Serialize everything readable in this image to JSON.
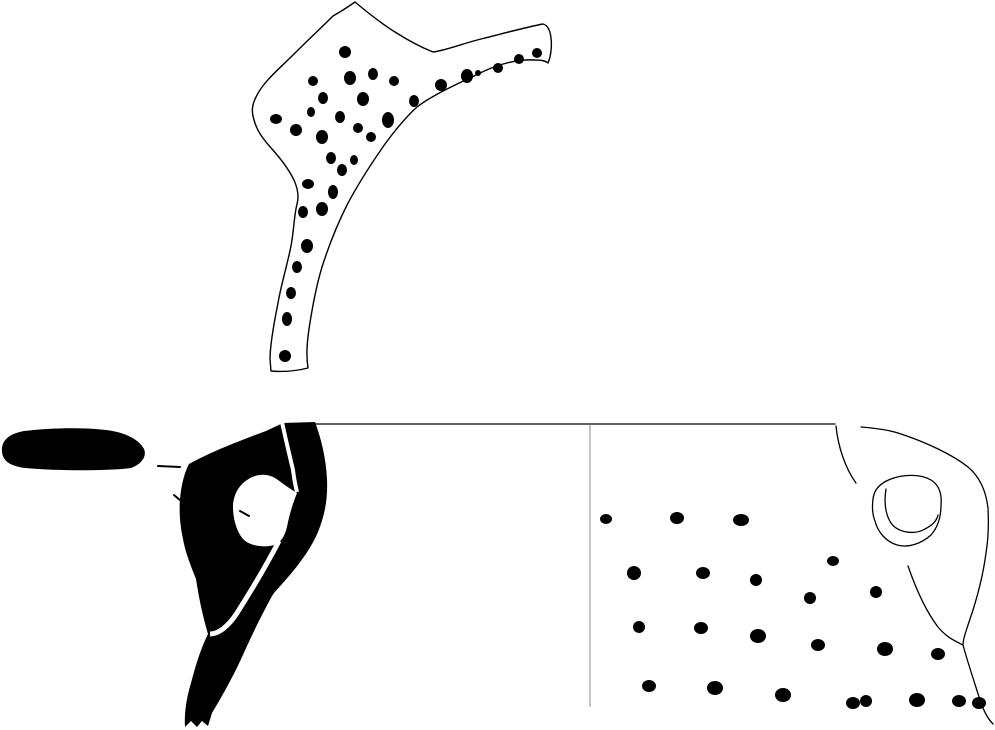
{
  "canvas": {
    "width": 995,
    "height": 730,
    "background": "#ffffff"
  },
  "palette": {
    "ink": "#000000",
    "paper": "#ffffff",
    "divider_line": "#888888"
  },
  "figures": [
    {
      "name": "decorated-sherd-top",
      "shapes": [
        {
          "name": "sherd-outline",
          "type": "path",
          "fill": "#ffffff",
          "stroke": "#000000",
          "sw": 1.4,
          "d": "M355 2 C348 7 340 12 333 16 C322 27 308 40 293 55 C279 69 263 82 256 97 C251 107 252 113 254 120 C257 131 263 139 272 149 C281 159 289 170 294 180 C298 189 299 197 297 204 C294 216 294 230 291 246 C287 266 281 285 278 303 C274 323 270 346 270 359 L271 371 C282 372 296 371 308 368 C306 355 307 343 309 329 C312 309 316 287 322 267 C329 245 337 225 347 205 C358 184 371 164 385 144 C396 129 407 116 417 107 C431 96 455 85 478 74 C498 64 518 59 535 60 C541 60 546 61 548 63 C551 56 552 46 551 38 C550 29 547 25 543 24 C527 27 505 33 481 39 C461 44 444 51 433 52 C423 48 409 41 395 32 C382 24 367 12 355 2 Z"
        },
        {
          "name": "punctate-dot",
          "type": "dots",
          "fill": "#000000",
          "items": [
            [
              345,
              52,
              6,
              6
            ],
            [
              313,
              81,
              5,
              5
            ],
            [
              350,
              78,
              6,
              7
            ],
            [
              373,
              74,
              5,
              6
            ],
            [
              394,
              81,
              5,
              5
            ],
            [
              441,
              85,
              6,
              6
            ],
            [
              467,
              76,
              6,
              7
            ],
            [
              478,
              73,
              3,
              3
            ],
            [
              498,
              68,
              5,
              5
            ],
            [
              519,
              59,
              5,
              5
            ],
            [
              537,
              53,
              5,
              5
            ],
            [
              323,
              98,
              5,
              6
            ],
            [
              363,
              99,
              6,
              7
            ],
            [
              414,
              101,
              5,
              6
            ],
            [
              311,
              112,
              4,
              5
            ],
            [
              276,
              119,
              6,
              5
            ],
            [
              340,
              117,
              5,
              6
            ],
            [
              388,
              120,
              6,
              8
            ],
            [
              296,
              130,
              6,
              6
            ],
            [
              358,
              128,
              5,
              5
            ],
            [
              322,
              137,
              6,
              7
            ],
            [
              371,
              137,
              5,
              5
            ],
            [
              331,
              158,
              5,
              6
            ],
            [
              354,
              160,
              4,
              5
            ],
            [
              342,
              170,
              5,
              6
            ],
            [
              308,
              184,
              6,
              5
            ],
            [
              333,
              192,
              5,
              7
            ],
            [
              303,
              212,
              5,
              6
            ],
            [
              322,
              209,
              6,
              7
            ],
            [
              307,
              246,
              6,
              7
            ],
            [
              297,
              267,
              5,
              6
            ],
            [
              291,
              293,
              5,
              6
            ],
            [
              287,
              319,
              5,
              7
            ],
            [
              285,
              356,
              6,
              6
            ]
          ]
        }
      ]
    },
    {
      "name": "handle-profile-left",
      "shapes": [
        {
          "name": "rim-section-blob",
          "type": "path",
          "fill": "#000000",
          "d": "M2 452 C1 441 8 434 24 431 C48 428 82 427 106 430 C124 432 139 439 144 449 C147 456 142 464 131 468 C108 471 58 471 25 468 C10 466 3 461 2 452 Z"
        },
        {
          "name": "profile-silhouette",
          "type": "path",
          "fill": "#000000",
          "d": "M283 423 L315 422 C321 438 326 458 327 479 C328 501 324 517 318 532 C309 553 294 571 274 593 L272 596 C261 616 251 637 242 657 C233 677 221 698 212 713 L208 726 L202 721 L197 727 L191 721 L185 727 C184 712 187 696 191 683 C196 664 201 648 208 634 C203 617 199 599 196 579 C190 564 185 551 183 539 C180 526 179 512 180 499 C181 487 184 473 189 464 C212 451 247 438 266 431 Z"
        },
        {
          "name": "handle-opening",
          "type": "path",
          "fill": "#ffffff",
          "d": "M233 507 C233 496 238 486 247 480 C257 473 269 473 278 480 C286 486 292 490 297 493 C293 503 290 513 288 522 C286 533 283 540 277 544 C268 548 252 547 244 540 C237 533 233 519 233 507 Z"
        },
        {
          "name": "rim-separation-line",
          "type": "path",
          "stroke": "#ffffff",
          "sw": 4,
          "cap": "butt",
          "d": "M282 422 C286 441 290 457 293 470 C294 478 296 488 297 492"
        },
        {
          "name": "handle-edge-line",
          "type": "path",
          "stroke": "#ffffff",
          "sw": 5,
          "cap": "butt",
          "d": "M279 541 C267 564 251 591 237 613 C228 627 218 634 210 634"
        },
        {
          "name": "tick-mark",
          "type": "path",
          "stroke": "#000000",
          "sw": 2,
          "d": "M158 466 L180 467"
        },
        {
          "name": "tick-mark",
          "type": "path",
          "stroke": "#000000",
          "sw": 2,
          "d": "M174 495 L181 501"
        },
        {
          "name": "tick-mark",
          "type": "path",
          "stroke": "#000000",
          "sw": 2,
          "d": "M240 511 L249 516"
        }
      ]
    },
    {
      "name": "vessel-view-right",
      "shapes": [
        {
          "name": "rim-top-line",
          "type": "path",
          "stroke": "#000000",
          "sw": 1.3,
          "d": "M313 424 L835 424"
        },
        {
          "name": "center-divider-line",
          "type": "path",
          "stroke": "#888888",
          "sw": 1,
          "cap": "butt",
          "d": "M590 425 L590 707"
        },
        {
          "name": "handle-attachment-curve",
          "type": "path",
          "stroke": "#000000",
          "sw": 1.3,
          "d": "M836 426 C838 446 845 468 856 483"
        },
        {
          "name": "rim-and-right-contour",
          "type": "path",
          "stroke": "#000000",
          "sw": 1.3,
          "d": "M861 427 C873 428 889 430 898 433 C926 442 953 455 968 467 C980 477 986 491 988 508 C989 527 988 541 986 553 C983 576 977 599 969 622 C965 634 963 640 963 645 C967 660 974 681 980 700 C984 712 988 719 993 724"
        },
        {
          "name": "body-contour-curve",
          "type": "path",
          "stroke": "#000000",
          "sw": 1.3,
          "d": "M908 566 C916 589 925 610 938 627 C946 637 955 641 963 645"
        },
        {
          "name": "handle-scar-outer",
          "type": "path",
          "stroke": "#000000",
          "sw": 1.3,
          "d": "M873 499 C874 490 880 483 891 479 C904 474 921 474 931 480 C939 485 942 494 941 505 C941 517 938 527 931 535 C921 544 908 548 897 545 C887 542 878 533 875 521 C872 514 872 507 873 499 Z"
        },
        {
          "name": "handle-scar-inner",
          "type": "path",
          "stroke": "#000000",
          "sw": 1.3,
          "d": "M886 489 C884 501 885 514 891 523 C898 533 915 535 925 529 C933 525 937 520 938 515"
        },
        {
          "name": "punctate-dot",
          "type": "dots",
          "fill": "#000000",
          "items": [
            [
              606,
              519,
              6,
              5
            ],
            [
              677,
              518,
              7,
              6
            ],
            [
              741,
              520,
              8,
              6
            ],
            [
              634,
              573,
              7,
              7
            ],
            [
              703,
              573,
              7,
              6
            ],
            [
              756,
              580,
              6,
              6
            ],
            [
              833,
              561,
              6,
              5
            ],
            [
              876,
              592,
              6,
              6
            ],
            [
              810,
              598,
              6,
              6
            ],
            [
              639,
              627,
              6,
              6
            ],
            [
              701,
              628,
              7,
              6
            ],
            [
              758,
              636,
              8,
              7
            ],
            [
              818,
              645,
              7,
              6
            ],
            [
              885,
              649,
              8,
              7
            ],
            [
              938,
              654,
              7,
              6
            ],
            [
              649,
              686,
              7,
              6
            ],
            [
              715,
              688,
              8,
              7
            ],
            [
              783,
              695,
              8,
              7
            ],
            [
              853,
              703,
              7,
              6
            ],
            [
              866,
              701,
              6,
              6
            ],
            [
              917,
              700,
              8,
              7
            ],
            [
              959,
              701,
              7,
              6
            ],
            [
              979,
              703,
              7,
              6
            ]
          ]
        }
      ]
    }
  ]
}
